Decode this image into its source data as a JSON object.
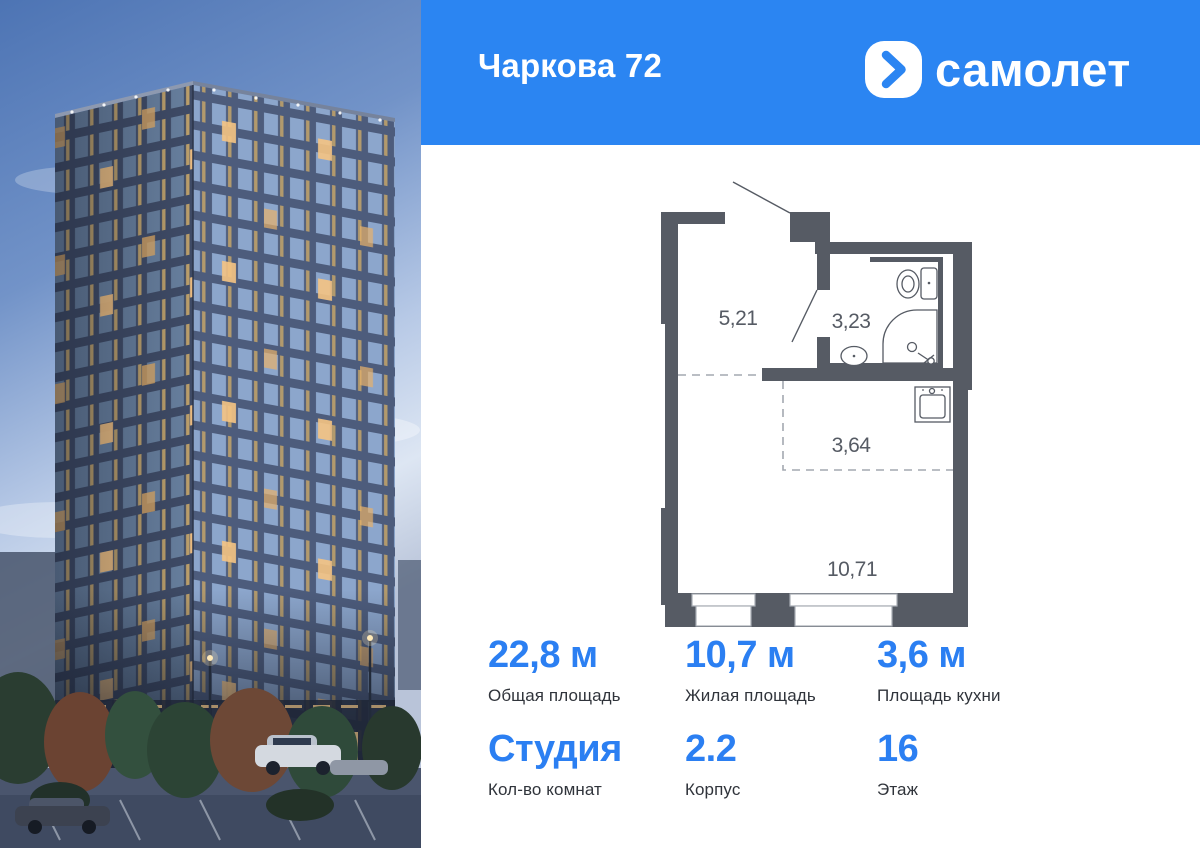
{
  "header": {
    "title": "Чаркова 72",
    "brand": "самолет"
  },
  "floorplan": {
    "rooms": [
      {
        "id": "hallway",
        "area": "5,21"
      },
      {
        "id": "bathroom",
        "area": "3,23"
      },
      {
        "id": "kitchen-zone",
        "area": "3,64"
      },
      {
        "id": "living-room",
        "area": "10,71"
      }
    ]
  },
  "stats": {
    "cells": [
      {
        "value": "22,8 м",
        "label": "Общая площадь"
      },
      {
        "value": "10,7 м",
        "label": "Жилая площадь"
      },
      {
        "value": "3,6 м",
        "label": "Площадь кухни"
      },
      {
        "value": "Студия",
        "label": "Кол-во комнат"
      },
      {
        "value": "2.2",
        "label": "Корпус"
      },
      {
        "value": "16",
        "label": "Этаж"
      }
    ]
  },
  "colors": {
    "accent": "#2b7ff2",
    "header_bg": "#2b85f2",
    "plan_wall": "#565b64"
  }
}
